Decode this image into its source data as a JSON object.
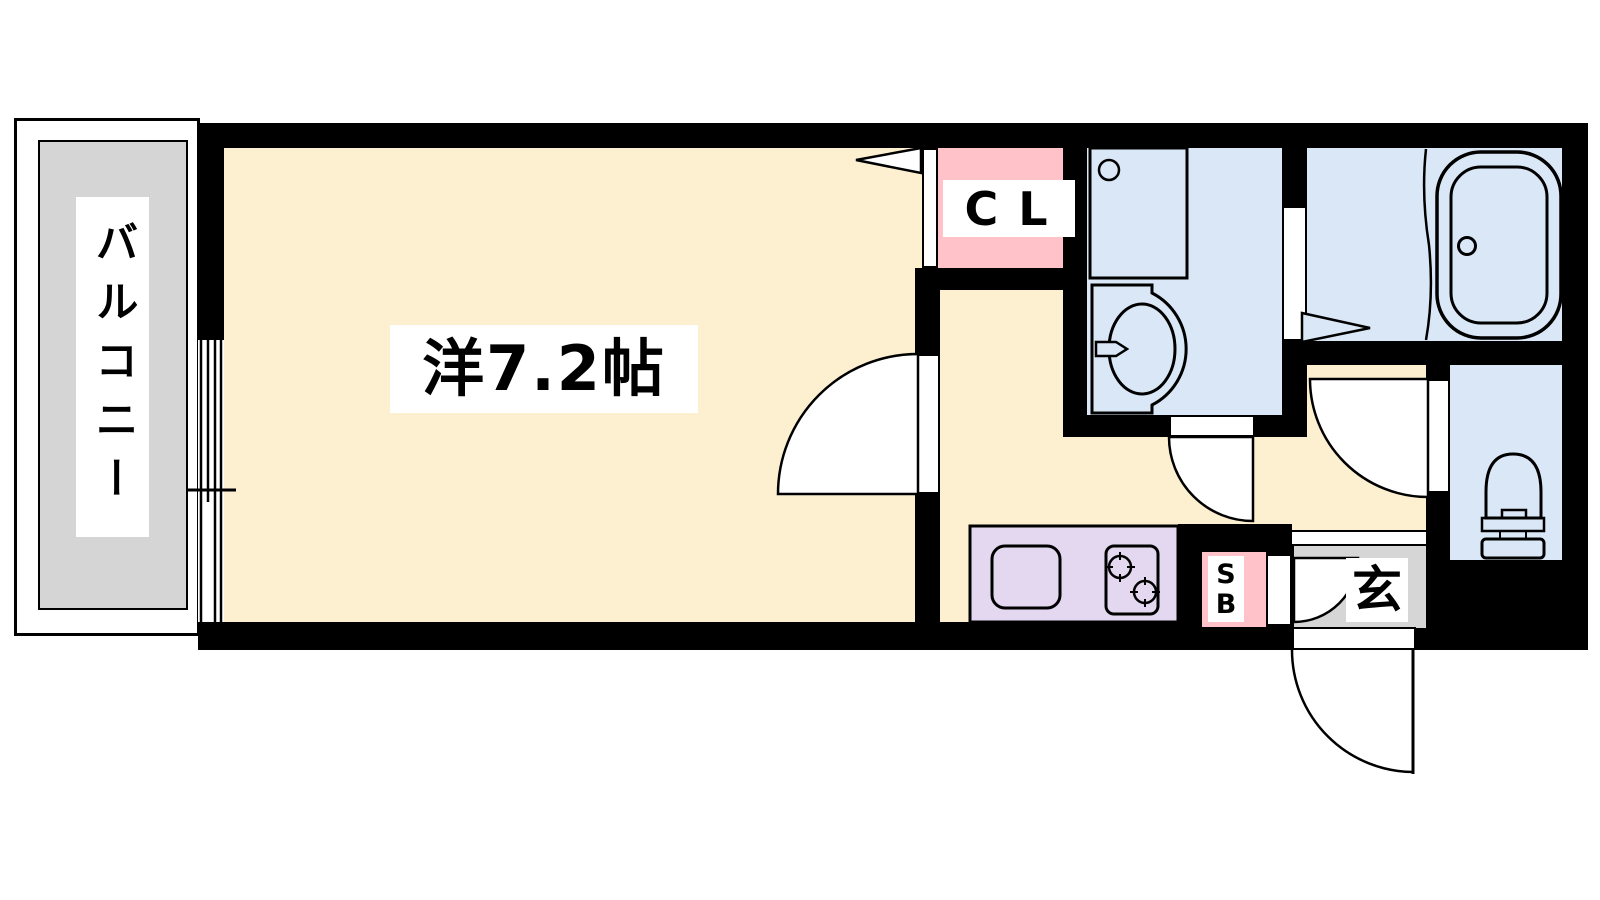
{
  "labels": {
    "balcony": "バルコニー",
    "main_room": "洋7.2帖",
    "closet": "CL",
    "shoe_box_s": "S",
    "shoe_box_b": "B",
    "entrance": "玄"
  },
  "palette": {
    "wall": "#000000",
    "room_cream": "#FCF0D0",
    "water_blue": "#D9E7F7",
    "closet_pink": "#FFC2C8",
    "kitchen_lavender": "#E4D7F0",
    "balcony_gray": "#D5D5D5",
    "entrance_gray": "#D6D6D6",
    "label_background": "#FFFFFF",
    "outline": "#000000"
  },
  "fixture_icons": [
    "bathtub-icon",
    "washing-machine-icon",
    "washbasin-icon",
    "toilet-icon",
    "kitchen-sink-icon",
    "gas-stove-icon",
    "sliding-window-icon",
    "folding-door-icon",
    "swing-door-icon"
  ]
}
